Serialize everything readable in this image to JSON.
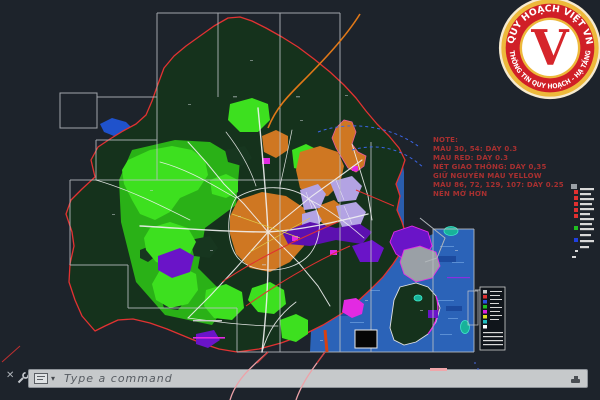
{
  "window": {
    "width": 600,
    "height": 400,
    "background": "#1d232b",
    "description": "CAD viewport showing a master plan map of a Vietnamese province"
  },
  "drawing": {
    "note": {
      "color": "#a83030",
      "lines": [
        "NOTE:",
        "MÀU 30, 54: DÀY 0.3",
        "MÀU RED: DÀY 0.3",
        "NÉT GIAO THÔNG: DÀY 0,35",
        "GIỮ NGUYÊN MÀU YELLOW",
        "MÀU 86, 72, 129, 107: DÀY 0.25",
        "NÊN MỜ HƠN"
      ]
    },
    "colors": {
      "land": "#15321c",
      "vegetation": "#2cbf17",
      "vegetation_bright": "#3de01f",
      "urban": "#cf7722",
      "residential": "#b3a3e3",
      "industrial": "#6a14c8",
      "water": "#1f52cc",
      "sea": "#2b63b8",
      "boundary": "#e23232",
      "road": "#f2f2f2",
      "highway": "#e07818",
      "accent_magenta": "#e22ae2",
      "frame": "#b9bdc2"
    }
  },
  "logo": {
    "top_text": "QUY HOẠCH VIỆT VN",
    "bottom_text": "THÔNG TIN QUY HOẠCH - HẠ TẦNG",
    "letter": "V",
    "ring_color": "#d01f27",
    "gold_color": "#edb93b"
  },
  "command_bar": {
    "placeholder": "Type a command",
    "close_glyph": "✕",
    "dropdown_glyph": "▾"
  }
}
